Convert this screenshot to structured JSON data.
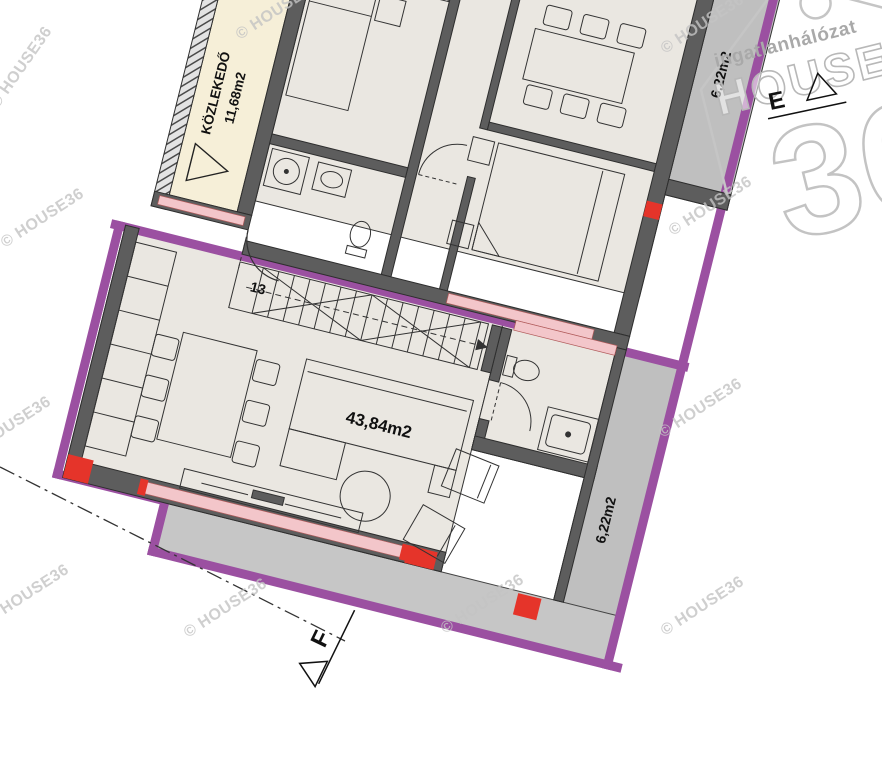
{
  "rooms": {
    "corridor": {
      "label": "KÖZLEKEDŐ",
      "area": "11,68m2"
    },
    "living": {
      "area": "43,84m2"
    },
    "balcony_right": {
      "area": "6,22m2"
    },
    "balcony_top": {
      "area": "6,22m2"
    },
    "entrance_door_number": "13"
  },
  "markers": {
    "section_f": "F",
    "section_e": "E"
  },
  "watermark": {
    "text": "© HOUSE36"
  },
  "logo": {
    "tagline": "ingatlanhálózat",
    "word": "HOUSE",
    "number": "36"
  },
  "colors": {
    "boundary_purple": "#9b50a1",
    "column_red": "#e5342a",
    "window_pink": "#f3c6ca",
    "corridor_cream": "#f6efd8",
    "floor_beige": "#eae7e1",
    "wall_gray": "#5d5d5d",
    "balcony_gray": "#bfbfbf",
    "terrace_gray": "#c6c6c6",
    "watermark_gray": "#c4c4c4",
    "logo_gray": "#c0c0c0"
  }
}
